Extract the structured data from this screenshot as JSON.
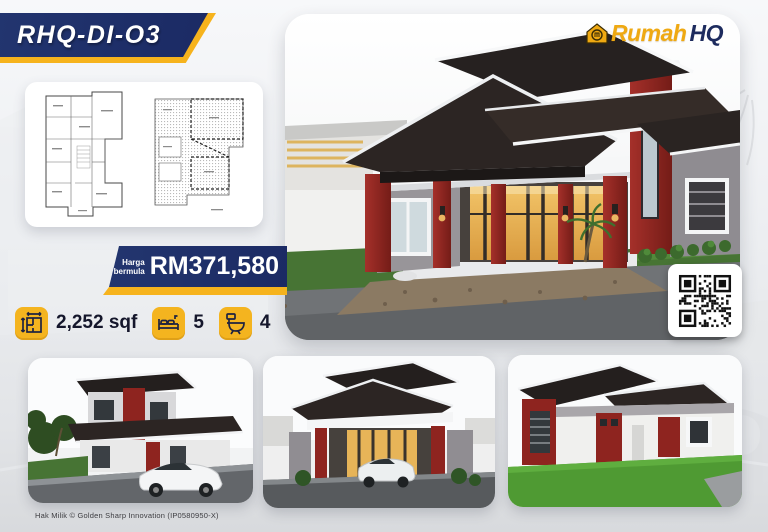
{
  "title_banner": {
    "model": "RHQ-DI-O3"
  },
  "logo": {
    "brand_primary": "Rumah",
    "brand_secondary": "HQ"
  },
  "price": {
    "label_top": "Harga",
    "label_bottom": "bermula",
    "amount": "RM371,580"
  },
  "specs": {
    "area": {
      "icon": "floor-area-icon",
      "value": "2,252 sqf"
    },
    "bedrooms": {
      "icon": "bed-icon",
      "value": "5"
    },
    "bathrooms": {
      "icon": "toilet-icon",
      "value": "4"
    }
  },
  "footer": {
    "copyright": "Hak Milik © Golden Sharp Innovation (IP0580950-X)"
  },
  "colors": {
    "navy": "#1d2b66",
    "yellow": "#f6b31d",
    "logo_yellow": "#efa912",
    "ink": "#14162b"
  },
  "images": {
    "main_alt": "3D render of bungalow with dark angular roofs, red columns and lit entrance",
    "floor_plan_alt": "floor plan",
    "roof_plan_alt": "roof slab plan",
    "qr_alt": "QR code",
    "thumb1_alt": "house render with white sports car",
    "thumb2_alt": "front elevation render with car under porch",
    "thumb3_alt": "side elevation render with lawn"
  }
}
